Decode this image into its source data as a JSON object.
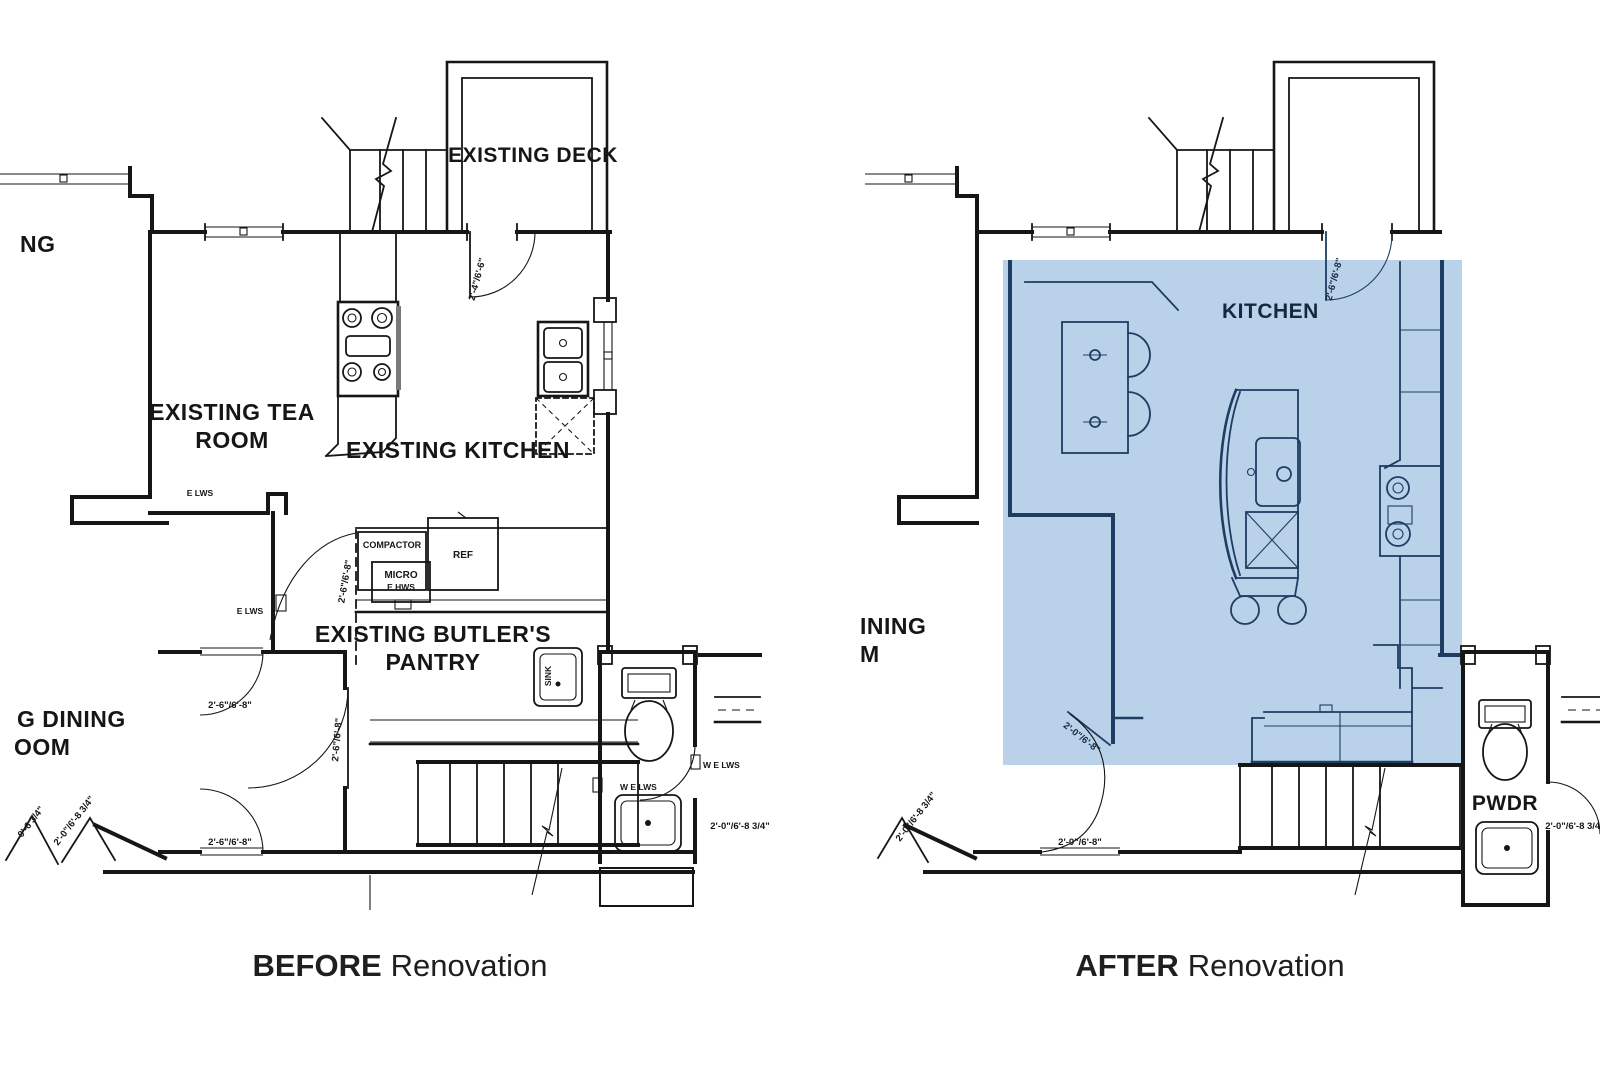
{
  "colors": {
    "background": "#ffffff",
    "linework": "#161616",
    "highlight_fill": "#b9d2ea",
    "highlight_linework": "#1e3d63"
  },
  "captions": {
    "before_bold": "BEFORE",
    "before_rest": "Renovation",
    "after_bold": "AFTER",
    "after_rest": "Renovation"
  },
  "before": {
    "labels": {
      "living_partial": "NG",
      "deck": "EXISTING DECK",
      "tea_line1": "EXISTING TEA",
      "tea_line2": "ROOM",
      "kitchen": "EXISTING KITCHEN",
      "pantry_line1": "EXISTING BUTLER'S",
      "pantry_line2": "PANTRY",
      "dining_partial_line1": "G DINING",
      "dining_partial_line2": "OOM",
      "compactor": "COMPACTOR",
      "ref": "REF",
      "micro": "MICRO",
      "sink": "SINK"
    },
    "dims": {
      "entry_door": "2'-4\"/6'-6\"",
      "pantry_door": "2'-6\"/6'-8\"",
      "hall_door": "2'-6\"/6'-8\"",
      "opening_upper": "2'-6\"/6'-8\"",
      "opening_lower": "2'-6\"/6'-8\"",
      "bath_door": "2'-0\"/6'-8 3/4\"",
      "crack_small": "0'-6 3/4\"",
      "crack_large": "2'-0\"/6'-8 3/4\""
    },
    "notes": {
      "lws_tea": "E LWS",
      "lws_corridor": "E LWS",
      "hws_micro": "E HWS",
      "lws_bath_left": "W E LWS",
      "lws_bath_right": "W E LWS"
    }
  },
  "after": {
    "labels": {
      "kitchen": "KITCHEN",
      "dining_partial_line1": "INING",
      "dining_partial_line2": "M",
      "pwdr": "PWDR"
    },
    "dims": {
      "entry_door": "2'-6\"/6'-8\"",
      "interior_door": "2'-0\"/6'-8\"",
      "bottom_opening": "2'-0\"/6'-8\"",
      "crack": "2'-0\"/6'-8 3/4\"",
      "pwdr_door": "2'-0\"/6'-8 3/4\""
    }
  }
}
